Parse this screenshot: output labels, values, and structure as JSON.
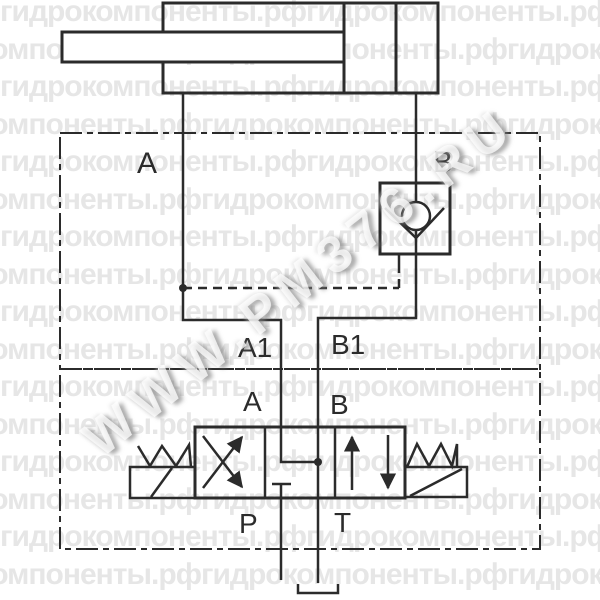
{
  "watermark": {
    "row_text": "гидрокомпоненты.рфгидрокомпоненты.рфгидрокомпоненты.рф",
    "diagonal_text": "WWW.РМ376.RU"
  },
  "labels": {
    "cyl_port_a": "А",
    "cyl_port_b": "В",
    "block_port_a1": "А1",
    "block_port_b1": "В1",
    "valve_port_a": "А",
    "valve_port_b": "В",
    "valve_port_p": "Р",
    "valve_port_t": "Т"
  },
  "colors": {
    "line": "#2b2b2b",
    "watermark_tile": "#e6e6e6"
  }
}
